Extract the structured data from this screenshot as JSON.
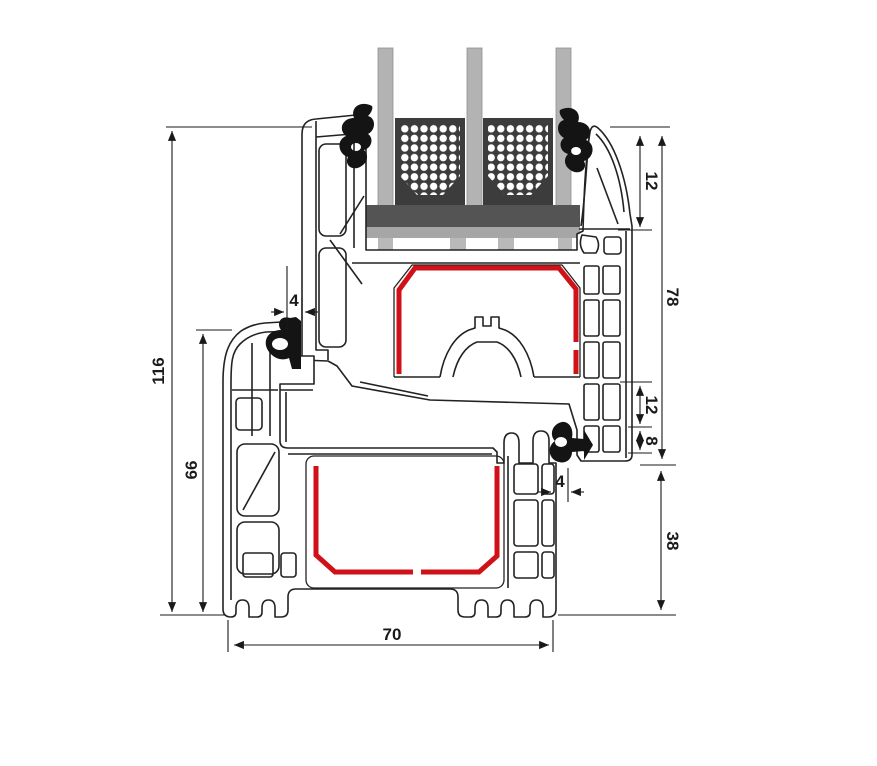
{
  "diagram": {
    "title": "uPVC window profile cross-section with triple glazing",
    "dims": {
      "total_height": "116",
      "frame_height": "66",
      "gasket_gap_top": "4",
      "glazing_edge_cover": "12",
      "sash_height": "78",
      "rebate_height": "12",
      "step_height": "8",
      "gasket_gap_bottom": "4",
      "lower_face_height": "38",
      "profile_depth": "70"
    },
    "colors": {
      "glass": "#b3b3b3",
      "spacer": "#3c3c3c",
      "bridge": "#545454",
      "bridge_light": "#a6a6a6",
      "packer": "#b9b9b9",
      "steel": "#d01118",
      "gasket": "#141414",
      "outline": "#222222"
    }
  }
}
